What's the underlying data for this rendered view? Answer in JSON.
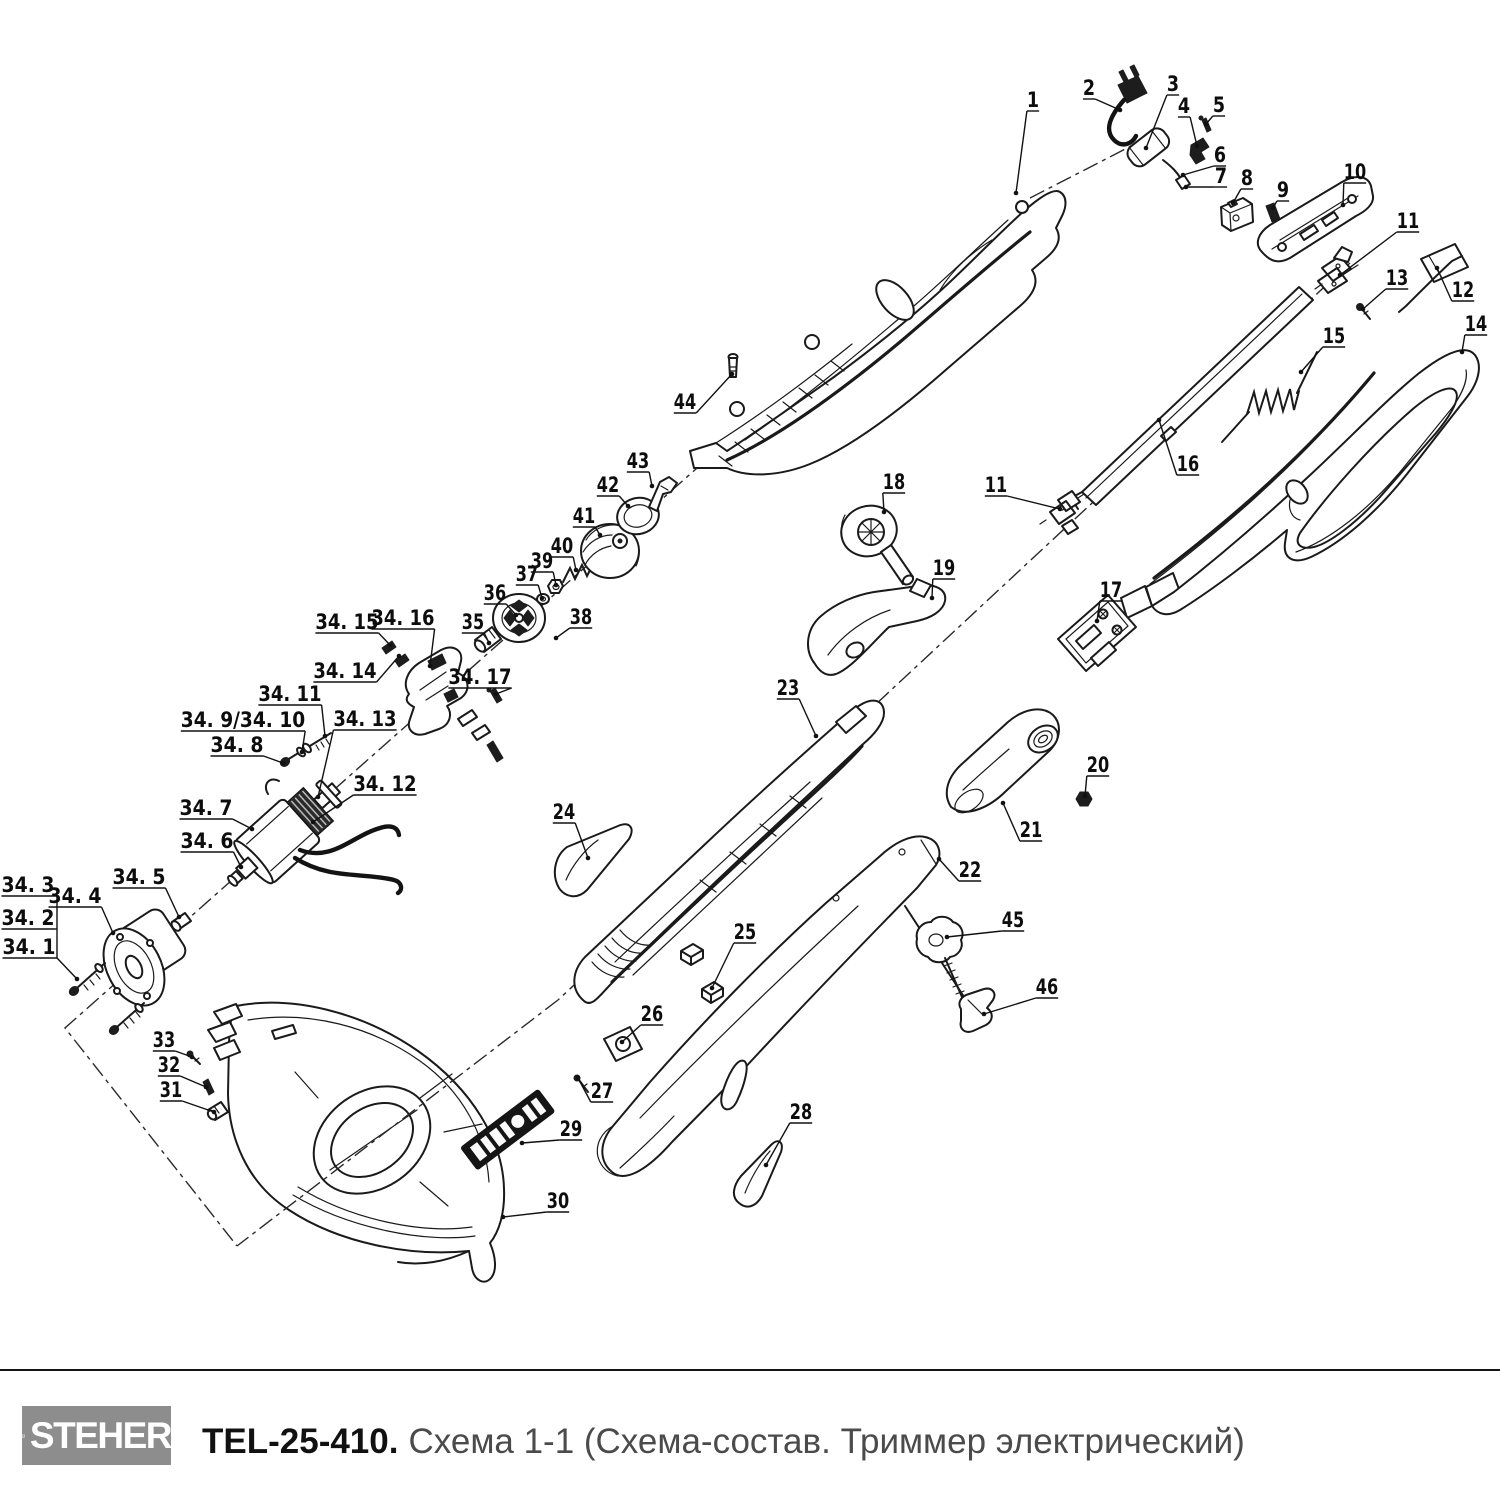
{
  "footer": {
    "brand": "STEHER",
    "model": "TEL-25-410.",
    "subtitle": "Схема 1-1 (Схема-состав. Триммер электрический)"
  },
  "diagram": {
    "labels": [
      {
        "t": "1",
        "x": 1033,
        "y": 100,
        "tx": 1016,
        "ty": 193
      },
      {
        "t": "2",
        "x": 1089,
        "y": 88,
        "tx": 1120,
        "ty": 110
      },
      {
        "t": "3",
        "x": 1173,
        "y": 84,
        "tx": 1146,
        "ty": 148
      },
      {
        "t": "4",
        "x": 1184,
        "y": 106,
        "tx": 1197,
        "ty": 146
      },
      {
        "t": "5",
        "x": 1219,
        "y": 105,
        "tx": 1206,
        "ty": 124
      },
      {
        "t": "6",
        "x": 1220,
        "y": 155,
        "tx": 1183,
        "ty": 175
      },
      {
        "t": "7",
        "x": 1221,
        "y": 176,
        "tx": 1186,
        "ty": 187
      },
      {
        "t": "8",
        "x": 1247,
        "y": 178,
        "tx": 1233,
        "ty": 203
      },
      {
        "t": "9",
        "x": 1283,
        "y": 190,
        "tx": 1273,
        "ty": 208
      },
      {
        "t": "10",
        "x": 1355,
        "y": 172,
        "tx": 1343,
        "ty": 205
      },
      {
        "t": "11",
        "x": 1408,
        "y": 221,
        "tx": 1340,
        "ty": 275
      },
      {
        "t": "12",
        "x": 1463,
        "y": 290,
        "tx": 1437,
        "ty": 268
      },
      {
        "t": "13",
        "x": 1397,
        "y": 278,
        "tx": 1363,
        "ty": 309
      },
      {
        "t": "14",
        "x": 1476,
        "y": 324,
        "tx": 1462,
        "ty": 352
      },
      {
        "t": "15",
        "x": 1334,
        "y": 336,
        "tx": 1301,
        "ty": 372
      },
      {
        "t": "16",
        "x": 1188,
        "y": 464,
        "tx": 1159,
        "ty": 420
      },
      {
        "t": "17",
        "x": 1111,
        "y": 590,
        "tx": 1097,
        "ty": 621
      },
      {
        "t": "18",
        "x": 894,
        "y": 482,
        "tx": 884,
        "ty": 512
      },
      {
        "t": "11",
        "x": 996,
        "y": 485,
        "tx": 1060,
        "ty": 509
      },
      {
        "t": "19",
        "x": 944,
        "y": 568,
        "tx": 932,
        "ty": 598
      },
      {
        "t": "20",
        "x": 1098,
        "y": 765,
        "tx": 1085,
        "ty": 796
      },
      {
        "t": "21",
        "x": 1031,
        "y": 830,
        "tx": 1003,
        "ty": 803
      },
      {
        "t": "22",
        "x": 970,
        "y": 870,
        "tx": 939,
        "ty": 859
      },
      {
        "t": "23",
        "x": 788,
        "y": 688,
        "tx": 816,
        "ty": 736
      },
      {
        "t": "24",
        "x": 564,
        "y": 812,
        "tx": 588,
        "ty": 858
      },
      {
        "t": "25",
        "x": 745,
        "y": 932,
        "tx": 712,
        "ty": 988
      },
      {
        "t": "26",
        "x": 652,
        "y": 1014,
        "tx": 622,
        "ty": 1042
      },
      {
        "t": "27",
        "x": 602,
        "y": 1091,
        "tx": 578,
        "ty": 1078
      },
      {
        "t": "28",
        "x": 801,
        "y": 1112,
        "tx": 766,
        "ty": 1165
      },
      {
        "t": "29",
        "x": 571,
        "y": 1129,
        "tx": 522,
        "ty": 1143
      },
      {
        "t": "30",
        "x": 558,
        "y": 1201,
        "tx": 503,
        "ty": 1217
      },
      {
        "t": "31",
        "x": 171,
        "y": 1090,
        "tx": 214,
        "ty": 1112
      },
      {
        "t": "32",
        "x": 169,
        "y": 1065,
        "tx": 206,
        "ty": 1087
      },
      {
        "t": "33",
        "x": 164,
        "y": 1040,
        "tx": 192,
        "ty": 1057
      },
      {
        "t": "34. 1",
        "x": 29,
        "y": 947,
        "tx": 57,
        "ty": 958,
        "nd": 1
      },
      {
        "t": "34. 2",
        "x": 28,
        "y": 918,
        "tx": 57,
        "ty": 929,
        "nd": 1
      },
      {
        "t": "34. 3",
        "x": 28,
        "y": 885,
        "tx": 57,
        "ty": 896,
        "nd": 1
      },
      {
        "t": "34. 4",
        "x": 75,
        "y": 896,
        "tx": 113,
        "ty": 933
      },
      {
        "t": "34. 5",
        "x": 139,
        "y": 877,
        "tx": 179,
        "ty": 917
      },
      {
        "t": "34. 6",
        "x": 207,
        "y": 841,
        "tx": 241,
        "ty": 867
      },
      {
        "t": "34. 7",
        "x": 206,
        "y": 808,
        "tx": 252,
        "ty": 829
      },
      {
        "t": "34. 8",
        "x": 237,
        "y": 745,
        "tx": 283,
        "ty": 763
      },
      {
        "t": "34. 9/34. 10",
        "x": 243,
        "y": 720,
        "tx": 302,
        "ty": 752
      },
      {
        "t": "34. 11",
        "x": 290,
        "y": 694,
        "tx": 325,
        "ty": 736
      },
      {
        "t": "34. 12",
        "x": 385,
        "y": 784,
        "tx": 313,
        "ty": 822
      },
      {
        "t": "34. 13",
        "x": 365,
        "y": 719,
        "tx": 318,
        "ty": 797
      },
      {
        "t": "34. 14",
        "x": 345,
        "y": 671,
        "tx": 399,
        "ty": 656
      },
      {
        "t": "34. 15",
        "x": 347,
        "y": 622,
        "tx": 390,
        "ty": 645
      },
      {
        "t": "34. 16",
        "x": 403,
        "y": 618,
        "tx": 430,
        "ty": 666
      },
      {
        "t": "34. 17",
        "x": 480,
        "y": 677,
        "tx": 496,
        "ty": 694
      },
      {
        "t": "35",
        "x": 473,
        "y": 622,
        "tx": 489,
        "ty": 643
      },
      {
        "t": "36",
        "x": 495,
        "y": 593,
        "tx": 516,
        "ty": 615
      },
      {
        "t": "37",
        "x": 527,
        "y": 574,
        "tx": 542,
        "ty": 598
      },
      {
        "t": "38",
        "x": 581,
        "y": 617,
        "tx": 556,
        "ty": 638
      },
      {
        "t": "39",
        "x": 542,
        "y": 561,
        "tx": 556,
        "ty": 585
      },
      {
        "t": "40",
        "x": 562,
        "y": 546,
        "tx": 576,
        "ty": 570
      },
      {
        "t": "41",
        "x": 584,
        "y": 516,
        "tx": 600,
        "ty": 535
      },
      {
        "t": "42",
        "x": 608,
        "y": 485,
        "tx": 628,
        "ty": 506
      },
      {
        "t": "43",
        "x": 638,
        "y": 461,
        "tx": 652,
        "ty": 486
      },
      {
        "t": "44",
        "x": 685,
        "y": 402,
        "tx": 732,
        "ty": 374
      },
      {
        "t": "45",
        "x": 1013,
        "y": 920,
        "tx": 947,
        "ty": 937
      },
      {
        "t": "46",
        "x": 1047,
        "y": 987,
        "tx": 984,
        "ty": 1014
      }
    ],
    "extra_lines": [
      [
        57,
        896,
        57,
        958
      ],
      [
        57,
        958,
        77,
        979
      ]
    ],
    "extra_dots": [
      [
        77,
        979
      ]
    ]
  }
}
